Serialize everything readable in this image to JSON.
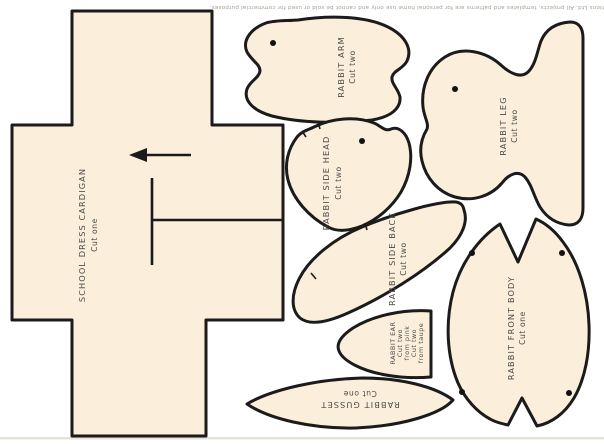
{
  "sheet": {
    "type": "sewing-pattern-cutting-sheet",
    "background_color": "#ffffff",
    "piece_fill_color": "#fbeeda",
    "outline_color": "#1b1b1b",
    "label_color": "#4b4b4b",
    "copyright_color": "#a49e93",
    "bottom_edge_color": "#e6e2d7"
  },
  "copyright": {
    "text": "© Aceville Publications Ltd. All projects, templates and patterns are for personal home use only and cannot be sold or used for commercial purposes."
  },
  "pieces": {
    "cardigan": {
      "name": "SCHOOL DRESS CARDIGAN",
      "cut": "Cut one"
    },
    "arm": {
      "name": "RABBIT ARM",
      "cut": "Cut two"
    },
    "leg": {
      "name": "RABBIT LEG",
      "cut": "Cut two"
    },
    "side_head": {
      "name": "RABBIT SIDE HEAD",
      "cut": "Cut two"
    },
    "side_back": {
      "name": "RABBIT SIDE BACK",
      "cut": "Cut two"
    },
    "ear": {
      "name": "RABBIT EAR",
      "cut_lines": [
        "Cut two",
        "from pink",
        "Cut two",
        "from taupe"
      ]
    },
    "gusset": {
      "name": "RABBIT GUSSET",
      "cut": "Cut one"
    },
    "front_body": {
      "name": "RABBIT FRONT BODY",
      "cut": "Cut one"
    }
  }
}
